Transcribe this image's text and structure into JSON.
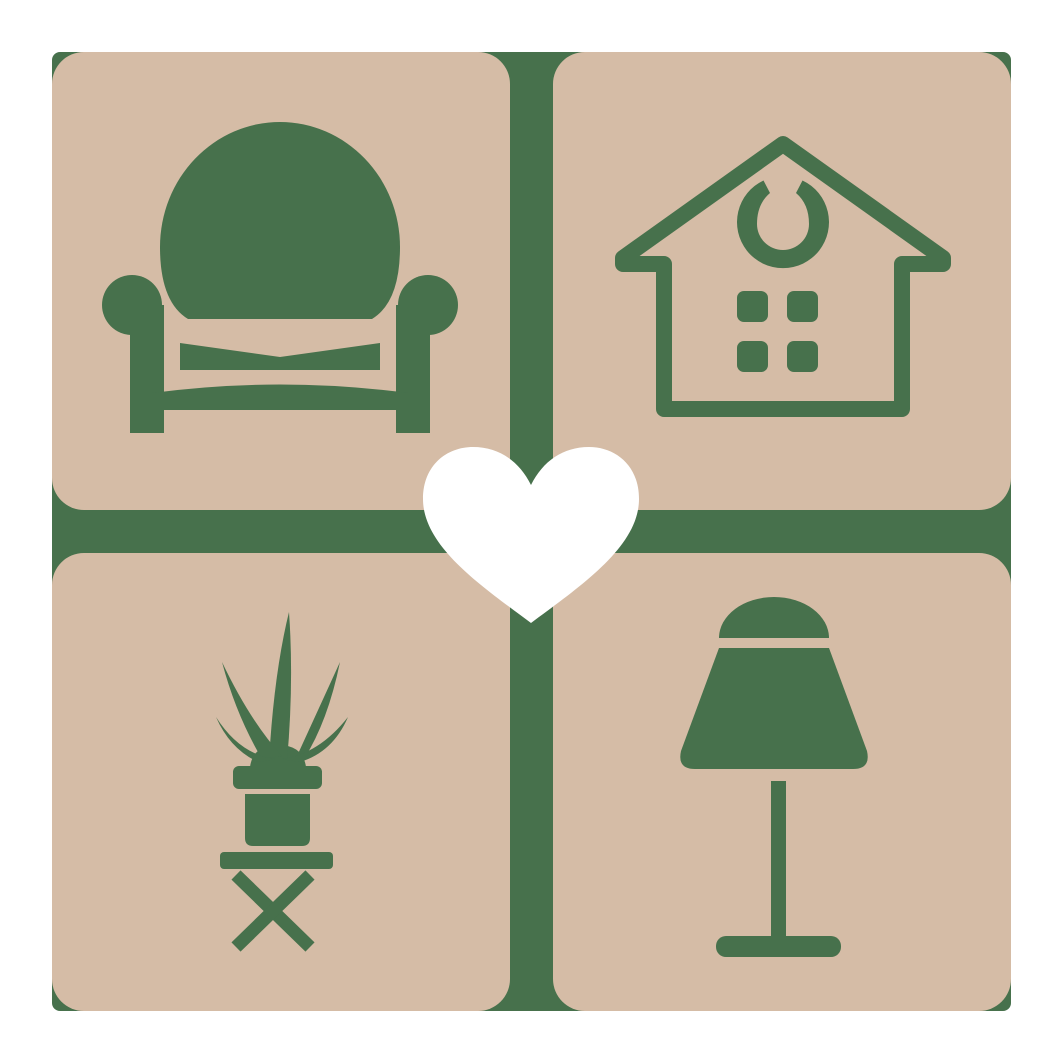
{
  "meta": {
    "description": "Square home-decor logo: four tan rounded tiles on a green backing forming a cross gap, each tile holding a green furniture icon, with a white heart at the center",
    "grid": "2x2",
    "tile_count": "4"
  },
  "colors": {
    "background": "#ffffff",
    "tile": "#d5bca6",
    "accent_green": "#47714c",
    "heart": "#ffffff"
  },
  "logo": {
    "tiles": [
      {
        "id": "armchair",
        "icon": "armchair-icon",
        "position": "top-left"
      },
      {
        "id": "house",
        "icon": "house-icon",
        "position": "top-right"
      },
      {
        "id": "potted-plant",
        "icon": "potted-plant-icon",
        "position": "bottom-left"
      },
      {
        "id": "table-lamp",
        "icon": "table-lamp-icon",
        "position": "bottom-right"
      }
    ],
    "center": {
      "id": "heart",
      "icon": "heart-icon"
    }
  }
}
